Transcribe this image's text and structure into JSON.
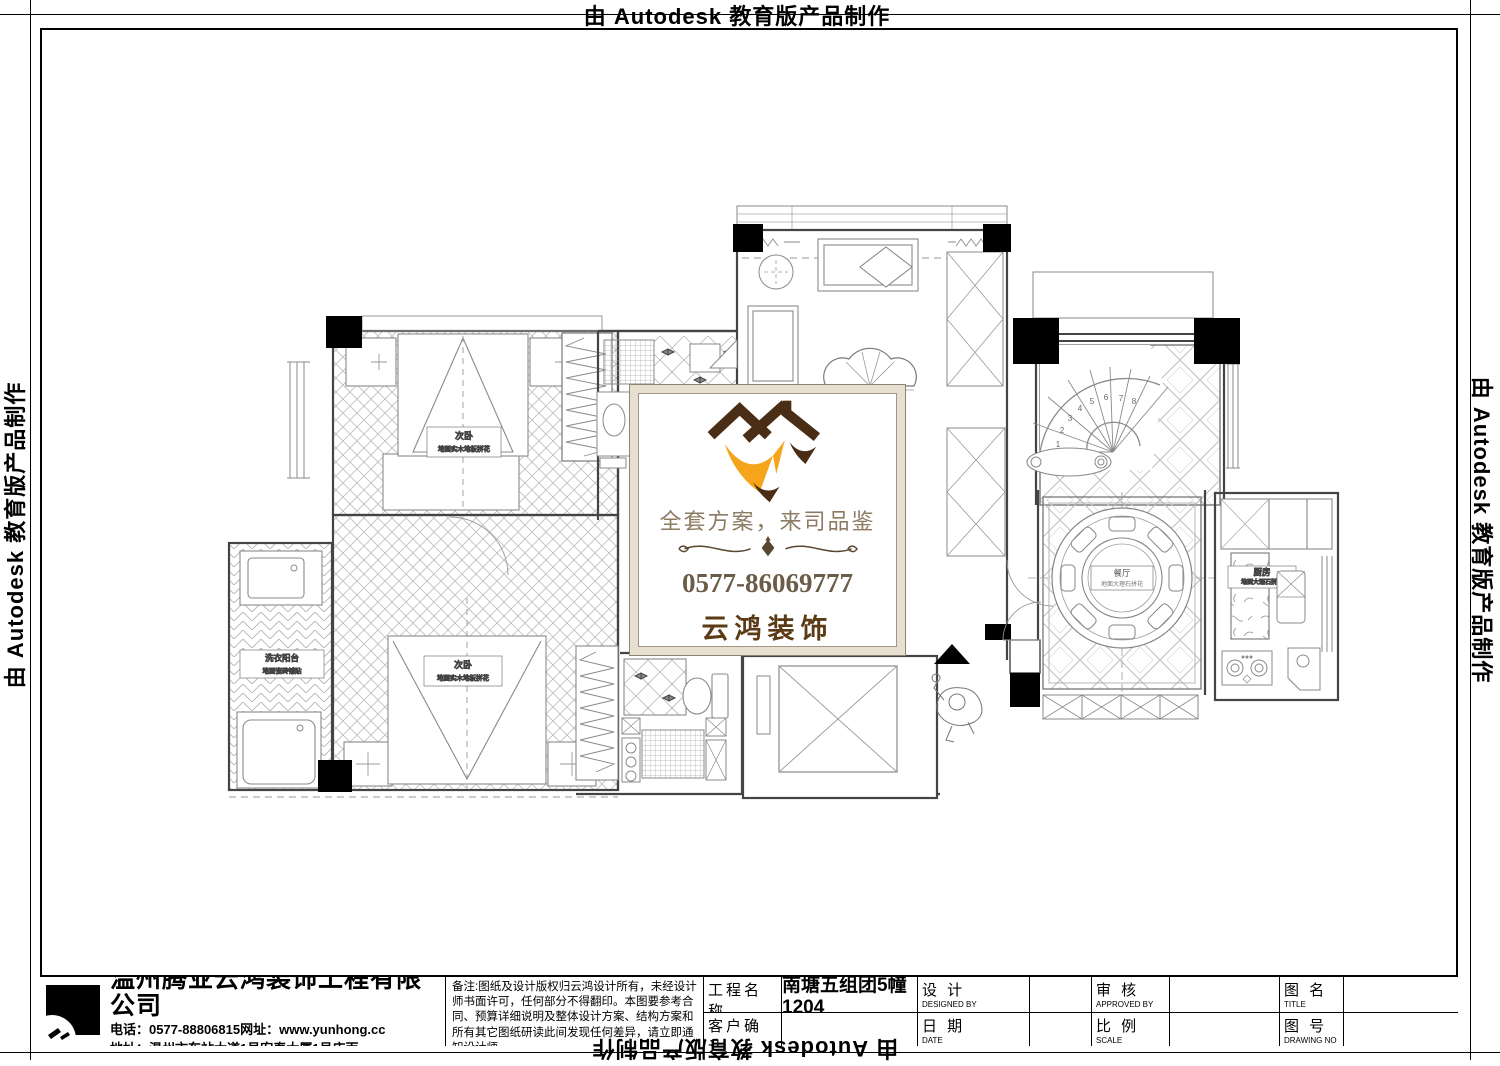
{
  "border": {
    "watermark_text": "由 Autodesk 教育版产品制作"
  },
  "watermark_card": {
    "slogan": "全套方案，来司品鉴",
    "phone": "0577-86069777",
    "brand": "云鸿装饰",
    "colors": {
      "roof_brown": "#4a2d15",
      "swoosh_gold": "#f6a41a",
      "frame_taupe": "#c9c0b2",
      "brand_text": "#5b3a16"
    }
  },
  "plan": {
    "rooms": {
      "bedroom_top": {
        "name": "次卧",
        "floor": "地面实木地板拼花"
      },
      "bedroom_bottom": {
        "name": "次卧",
        "floor": "地面实木地板拼花"
      },
      "laundry": {
        "name": "洗衣阳台",
        "floor": "地面瓷砖铺贴"
      },
      "dining": {
        "name": "餐厅",
        "floor": "地面大理石拼花"
      },
      "kitchen": {
        "name": "厨房",
        "floor": "地面大理石拼花"
      }
    },
    "stair_steps": [
      "1",
      "2",
      "3",
      "4",
      "5",
      "6",
      "7",
      "8"
    ]
  },
  "titleblock": {
    "company": {
      "name": "温州腾业云鸿装饰工程有限公司",
      "phone_line": "电话：0577-88806815网址：www.yunhong.cc",
      "address_line": "地址：温州市车站大道1号宏泰大厦1号店面"
    },
    "notes": "备注:图纸及设计版权归云鸿设计所有，未经设计师书面许可，任何部分不得翻印。本图要参考合同、预算详细说明及整体设计方案、结构方案和所有其它图纸研读此间发现任何差异，请立即通知设计师。",
    "fields": [
      {
        "label": "工程名称",
        "sub": "PROJECT",
        "value": "南塘五组团5幢1204"
      },
      {
        "label": "设  计",
        "sub": "DESIGNED BY",
        "value": ""
      },
      {
        "label": "审  核",
        "sub": "APPROVED BY",
        "value": ""
      },
      {
        "label": "图  名",
        "sub": "TITLE",
        "value": ""
      },
      {
        "label": "客户确认",
        "sub": "CONFIRM",
        "value": ""
      },
      {
        "label": "日  期",
        "sub": "DATE",
        "value": ""
      },
      {
        "label": "比  例",
        "sub": "SCALE",
        "value": ""
      },
      {
        "label": "图  号",
        "sub": "DRAWING NO",
        "value": ""
      }
    ]
  }
}
